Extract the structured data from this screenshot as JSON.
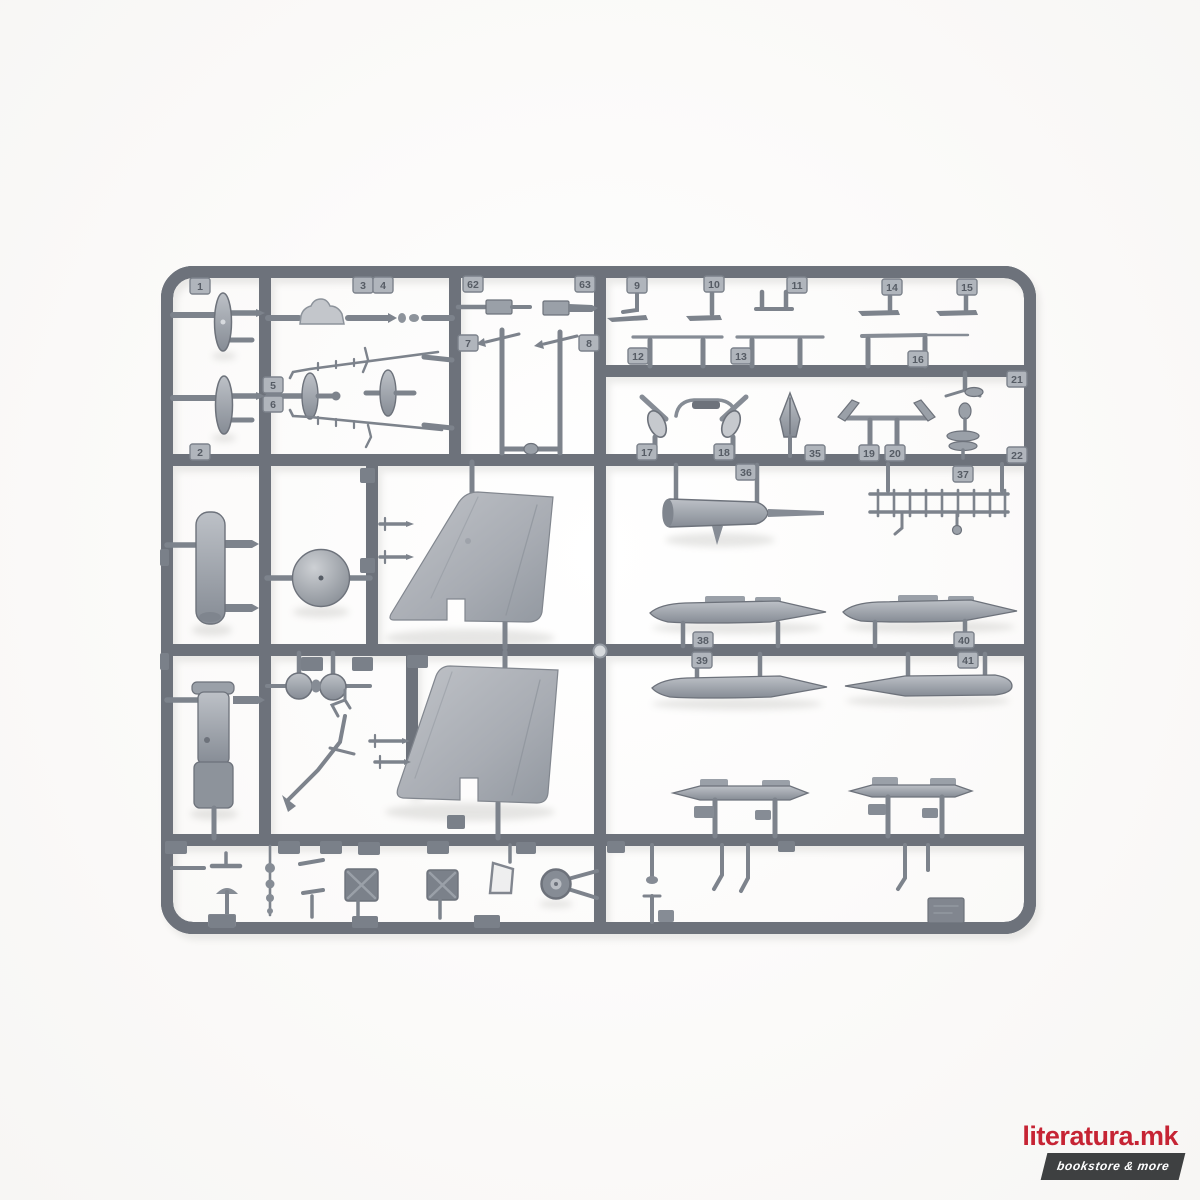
{
  "palette": {
    "background": "#f7f6f4",
    "plastic_dark": "#6d727b",
    "plastic_mid": "#989da5",
    "plastic_light": "#b9bdc3",
    "tag_fill": "#b0b5bc",
    "tag_text": "#565c65"
  },
  "sprue": {
    "tags": [
      {
        "n": "1",
        "x": 200,
        "y": 286
      },
      {
        "n": "2",
        "x": 200,
        "y": 452
      },
      {
        "n": "3",
        "x": 363,
        "y": 285
      },
      {
        "n": "4",
        "x": 383,
        "y": 285
      },
      {
        "n": "5",
        "x": 273,
        "y": 385
      },
      {
        "n": "6",
        "x": 273,
        "y": 404
      },
      {
        "n": "62",
        "x": 473,
        "y": 284
      },
      {
        "n": "63",
        "x": 585,
        "y": 284
      },
      {
        "n": "7",
        "x": 468,
        "y": 343
      },
      {
        "n": "8",
        "x": 589,
        "y": 343
      },
      {
        "n": "9",
        "x": 637,
        "y": 285
      },
      {
        "n": "10",
        "x": 714,
        "y": 284
      },
      {
        "n": "11",
        "x": 797,
        "y": 285
      },
      {
        "n": "14",
        "x": 892,
        "y": 287
      },
      {
        "n": "15",
        "x": 967,
        "y": 287
      },
      {
        "n": "12",
        "x": 638,
        "y": 356
      },
      {
        "n": "13",
        "x": 741,
        "y": 356
      },
      {
        "n": "16",
        "x": 918,
        "y": 359
      },
      {
        "n": "21",
        "x": 1017,
        "y": 379
      },
      {
        "n": "17",
        "x": 647,
        "y": 452
      },
      {
        "n": "18",
        "x": 724,
        "y": 452
      },
      {
        "n": "35",
        "x": 815,
        "y": 453
      },
      {
        "n": "19",
        "x": 869,
        "y": 453
      },
      {
        "n": "20",
        "x": 895,
        "y": 453
      },
      {
        "n": "22",
        "x": 1017,
        "y": 455
      },
      {
        "n": "36",
        "x": 746,
        "y": 472
      },
      {
        "n": "37",
        "x": 963,
        "y": 474
      },
      {
        "n": "38",
        "x": 703,
        "y": 640
      },
      {
        "n": "39",
        "x": 702,
        "y": 660
      },
      {
        "n": "40",
        "x": 964,
        "y": 640
      },
      {
        "n": "41",
        "x": 968,
        "y": 660
      }
    ]
  },
  "watermark": {
    "title": "literatura.mk",
    "subtitle": "bookstore & more",
    "title_color": "#c62434",
    "banner_color": "#3e4041",
    "subtitle_color": "#ffffff"
  }
}
